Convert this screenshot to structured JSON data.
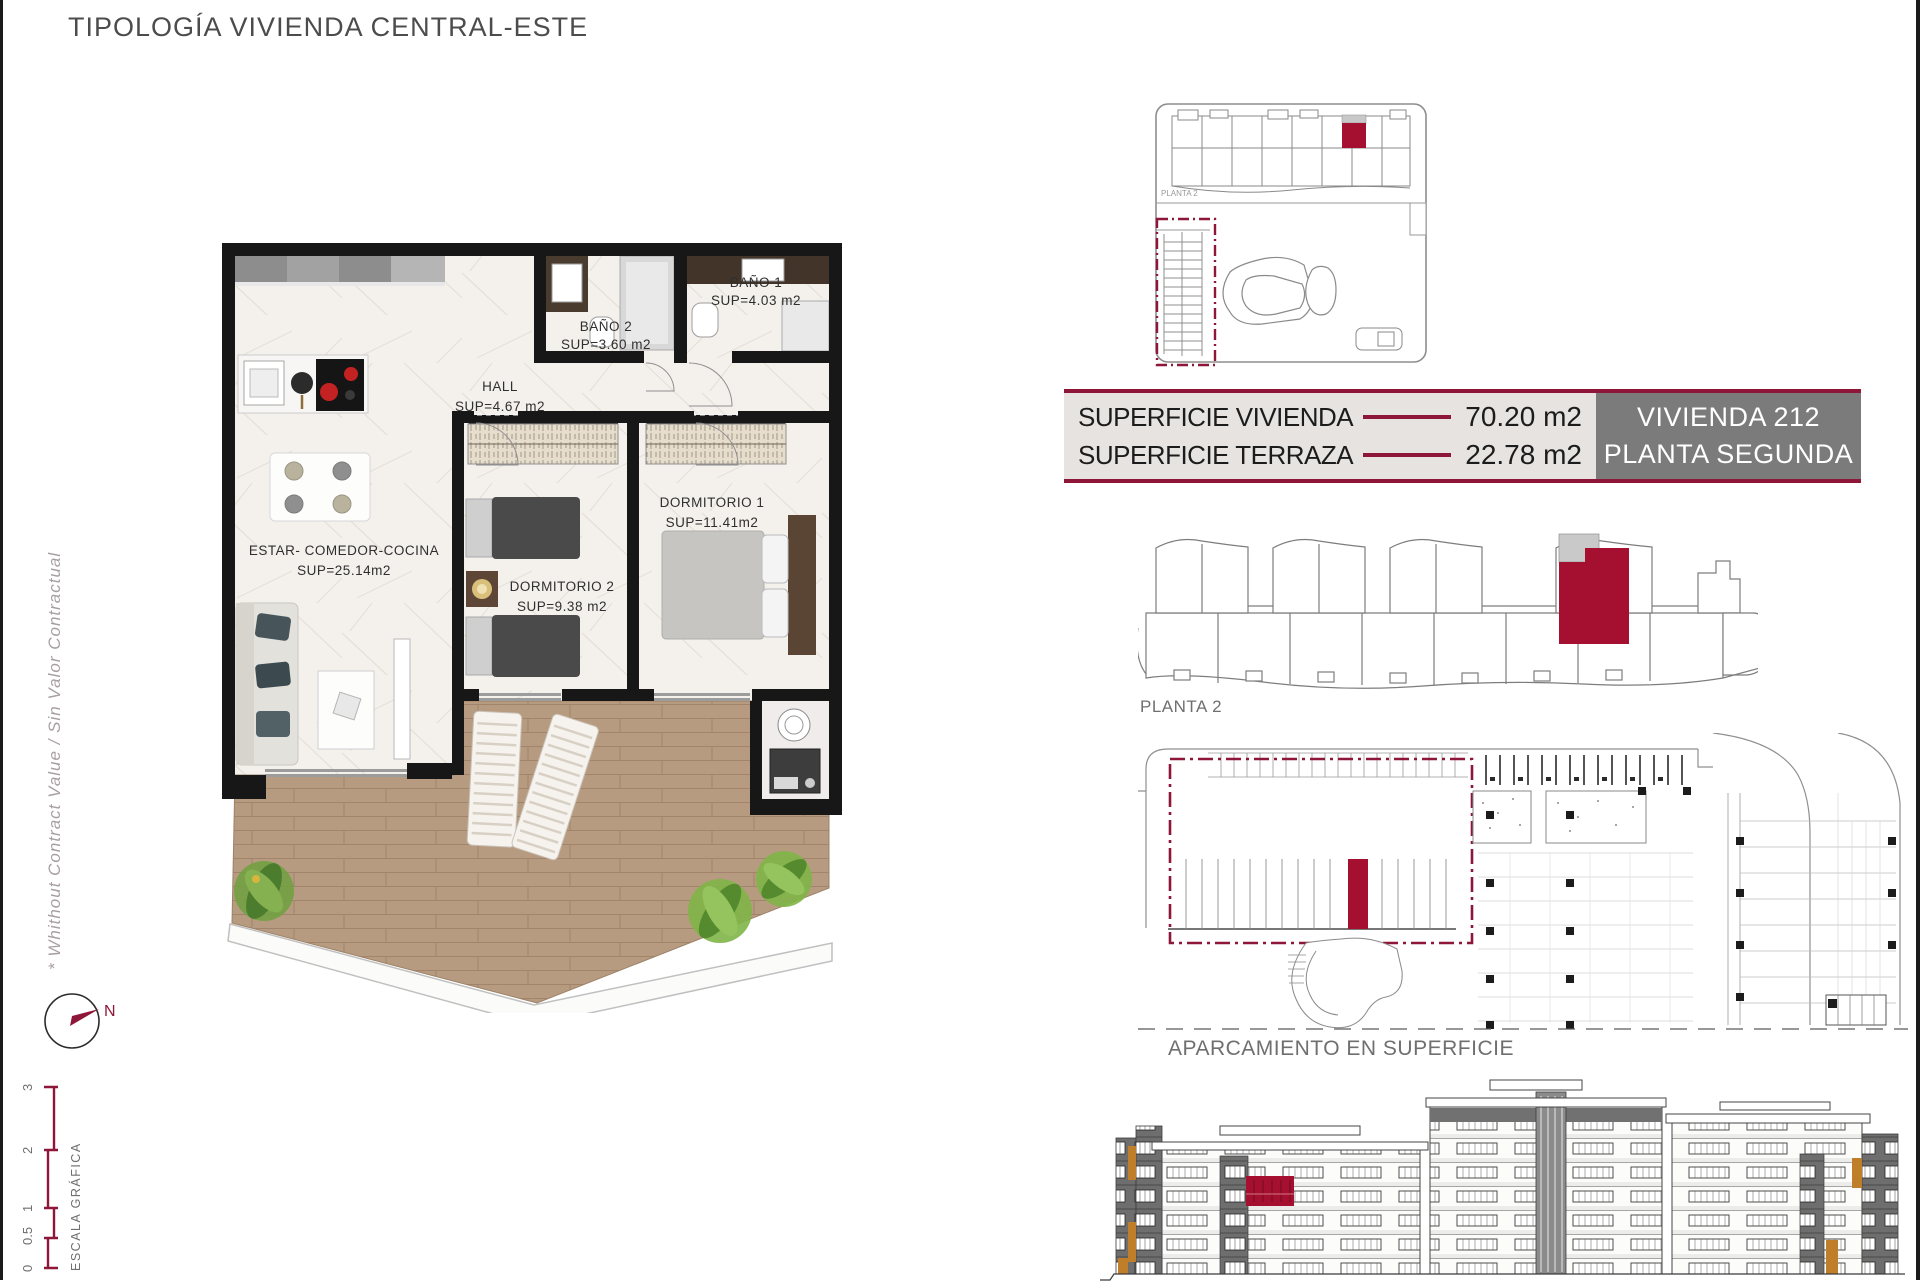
{
  "page": {
    "title": "TIPOLOGÍA VIVIENDA CENTRAL-ESTE",
    "disclaimer": "* Whithout Contract Value / Sin Valor Contractual"
  },
  "colors": {
    "accent_maroon": "#8e1638",
    "highlight_red": "#a51030",
    "unit_box_bg": "#7b7b7b",
    "table_bg": "#e6e3e1",
    "wall_black": "#171717",
    "wood_deck": "#b79b81",
    "orange_accent": "#bf7f2a"
  },
  "floor_plan": {
    "rooms": [
      {
        "name": "ESTAR-  COMEDOR-COCINA",
        "sup": "SUP=25.14m2"
      },
      {
        "name": "HALL",
        "sup": "SUP=4.67  m2"
      },
      {
        "name": "BAÑO  2",
        "sup": "SUP=3.60  m2"
      },
      {
        "name": "BAÑO  1",
        "sup": "SUP=4.03  m2"
      },
      {
        "name": "DORMITORIO  2",
        "sup": "SUP=9.38  m2"
      },
      {
        "name": "DORMITORIO  1",
        "sup": "SUP=11.41m2"
      }
    ]
  },
  "summary": {
    "rows": [
      {
        "label": "SUPERFICIE VIVIENDA",
        "value": "70.20 m2"
      },
      {
        "label": "SUPERFICIE TERRAZA",
        "value": "22.78 m2"
      }
    ],
    "unit": {
      "line1": "VIVIENDA 212",
      "line2": "PLANTA SEGUNDA"
    }
  },
  "diagrams": {
    "site_plan_label": "PLANTA 2",
    "planta2_label": "PLANTA 2",
    "parking_label": "APARCAMIENTO EN SUPERFICIE"
  },
  "compass": {
    "north": "N"
  },
  "scale_bar": {
    "title": "ESCALA GRÁFICA",
    "ticks": [
      "3",
      "2",
      "1",
      "0.5",
      "0"
    ]
  }
}
